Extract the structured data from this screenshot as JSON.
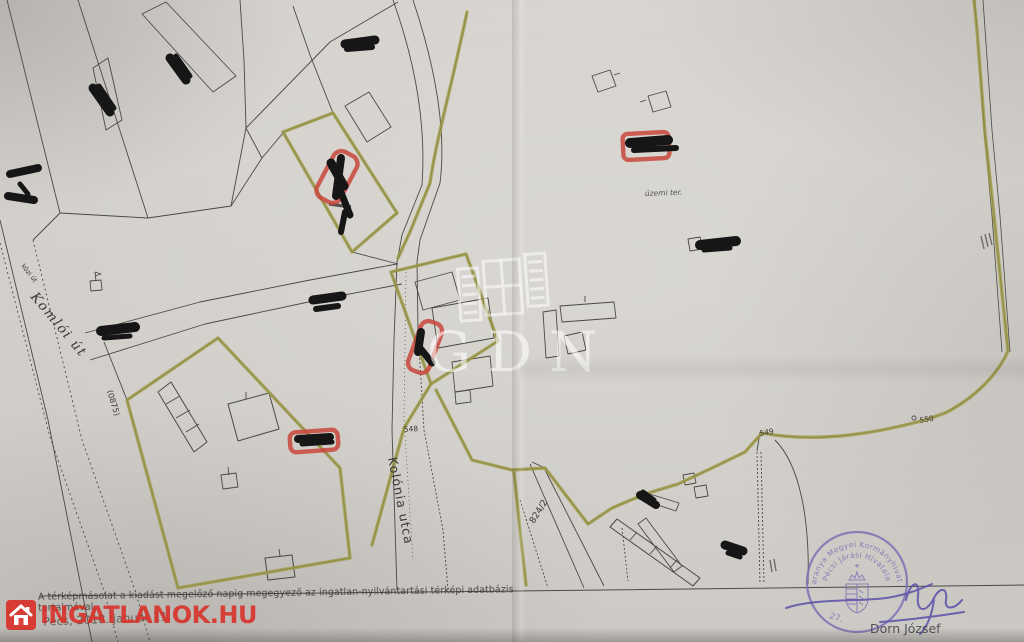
{
  "watermarks": {
    "gdn": {
      "letters": "GDN",
      "icon": "window-shutters-icon",
      "color": "#ffffff"
    },
    "portal": {
      "text": "INGATLANOK.HU",
      "icon": "house-icon",
      "color": "#d6352b"
    }
  },
  "map_labels": {
    "street_small": "közi út",
    "street_main": "Komlói út",
    "road_number": "(0875)",
    "street_colonia": "Kolónia utca",
    "point_548": "548",
    "point_549": "549",
    "point_550": "550",
    "parcel_824": "824/2",
    "area_note": "üzemi ter."
  },
  "marks": {
    "highlight_color": "#9c9a45",
    "marker_box_color": "#c9463c",
    "redaction_color": "#161616"
  },
  "footer": {
    "attestation": "A térképmásolat a kiadást megelőző napig megegyező az ingatlan-nyilvántartási térképi adatbázis tartalmával.",
    "date_line": "Pécs, 2018. január 11."
  },
  "stamp": {
    "ring_outer": "Baranya Megyei Kormányhivatal",
    "ring_inner": "Pécsi Járási Hivatala",
    "number": "27.",
    "signer": "Dorn József",
    "ink_color": "#7b6db3"
  }
}
